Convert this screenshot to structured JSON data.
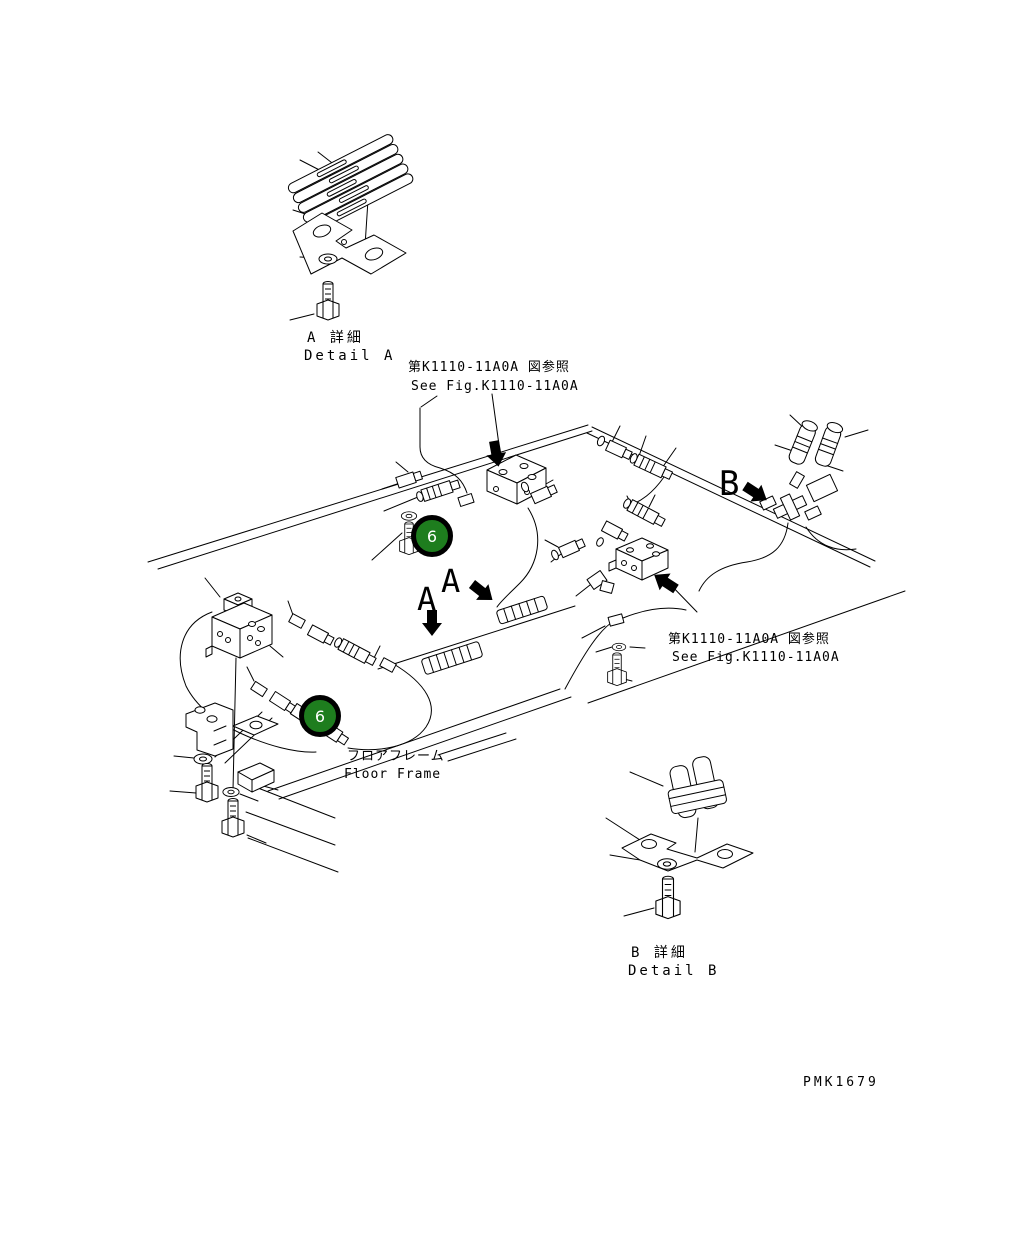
{
  "drawing": {
    "code": "PMK1679",
    "background": "#ffffff",
    "line_color": "#000000"
  },
  "labels": {
    "detail_a": {
      "jp": "A 詳細",
      "en": "Detail A"
    },
    "detail_b": {
      "jp": "B 詳細",
      "en": "Detail B"
    },
    "floor_frame": {
      "jp": "フロアフレーム",
      "en": "Floor Frame"
    },
    "see_fig": {
      "jp": "第K1110-11A0A 図参照",
      "en": "See Fig.K1110-11A0A"
    }
  },
  "section_markers": {
    "a": "A",
    "b": "B"
  },
  "callout": {
    "number": "6",
    "fill": "#1e7d1e",
    "ring": "#000000",
    "text": "#ffffff"
  }
}
